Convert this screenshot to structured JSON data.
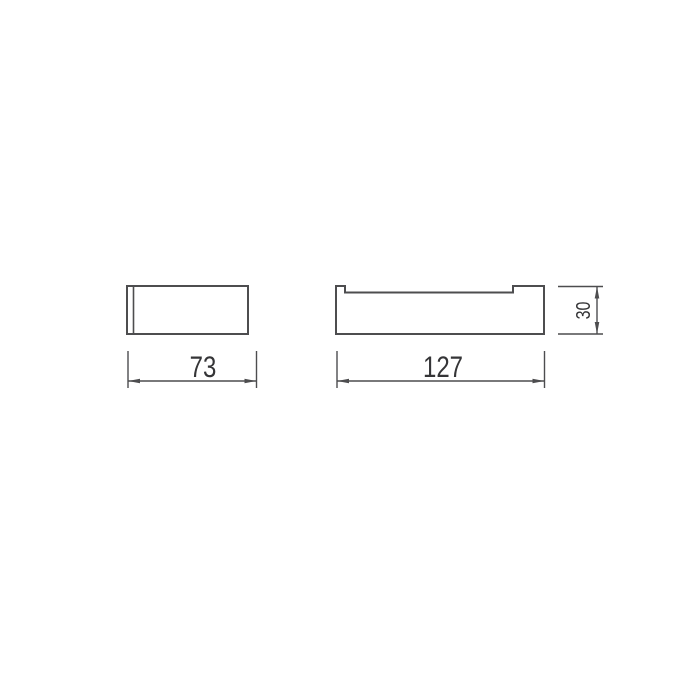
{
  "colors": {
    "background": "#ffffff",
    "line": "#4d4d4f",
    "text": "#353537"
  },
  "drawing": {
    "dimensions": {
      "front_width": "73",
      "side_width": "127",
      "side_height": "30"
    }
  }
}
